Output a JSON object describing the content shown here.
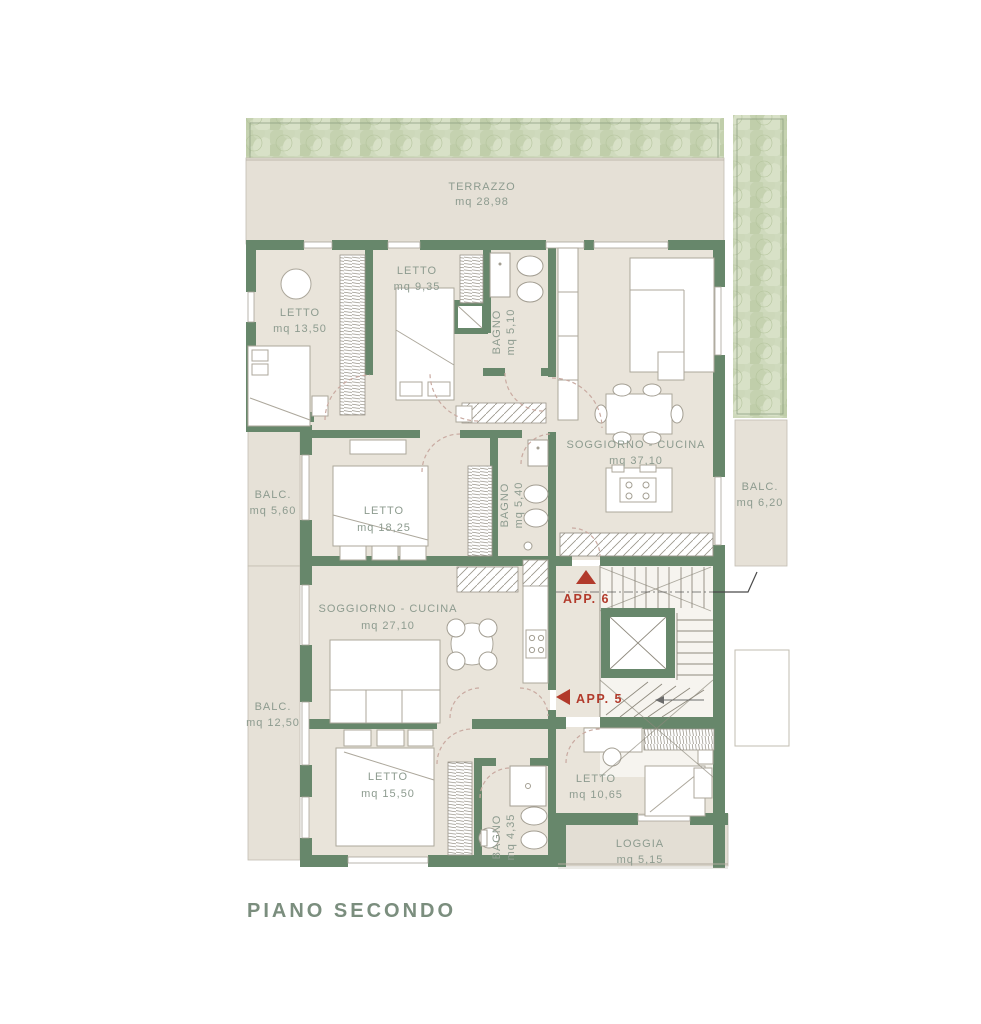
{
  "title": "PIANO SECONDO",
  "colors": {
    "wall_green": "#67876b",
    "floor_beige": "#e9e4da",
    "terrace_beige": "#e5e0d6",
    "hedge_green": "#cfdabd",
    "label_green": "#8d9b8f",
    "title_green": "#7b8e7e",
    "accent_red": "#b23a2b"
  },
  "apartments": {
    "app5": {
      "label": "APP. 5"
    },
    "app6": {
      "label": "APP. 6"
    }
  },
  "rooms": {
    "terrazzo": {
      "name": "TERRAZZO",
      "area": "mq 28,98"
    },
    "letto_13_50": {
      "name": "LETTO",
      "area": "mq 13,50"
    },
    "letto_9_35": {
      "name": "LETTO",
      "area": "mq 9,35"
    },
    "bagno_5_10": {
      "name": "BAGNO",
      "area": "mq 5,10"
    },
    "soggiorno_37": {
      "name": "SOGGIORNO - CUCINA",
      "area": "mq 37,10"
    },
    "balc_6_20": {
      "name": "BALC.",
      "area": "mq 6,20"
    },
    "balc_5_60": {
      "name": "BALC.",
      "area": "mq 5,60"
    },
    "letto_18_25": {
      "name": "LETTO",
      "area": "mq 18,25"
    },
    "bagno_5_40": {
      "name": "BAGNO",
      "area": "mq 5,40"
    },
    "soggiorno_27": {
      "name": "SOGGIORNO - CUCINA",
      "area": "mq 27,10"
    },
    "balc_12_50": {
      "name": "BALC.",
      "area": "mq 12,50"
    },
    "letto_15_50": {
      "name": "LETTO",
      "area": "mq 15,50"
    },
    "bagno_4_35": {
      "name": "BAGNO",
      "area": "mq 4,35"
    },
    "letto_10_65": {
      "name": "LETTO",
      "area": "mq 10,65"
    },
    "loggia": {
      "name": "LOGGIA",
      "area": "mq 5,15"
    }
  }
}
